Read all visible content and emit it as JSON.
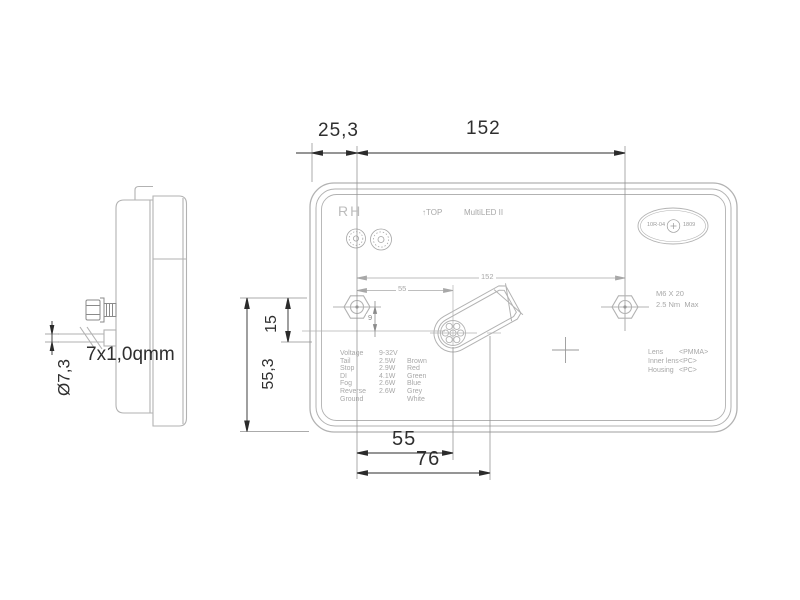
{
  "drawing": {
    "side_view": {
      "cable_spec": "7x1,0qmm",
      "cable_diameter": "Ø7,3",
      "icons": [
        "mounting-stud-icon",
        "cable-break-icon"
      ]
    },
    "dims": {
      "top_offset": "25,3",
      "hole_spacing_top": "152",
      "hole_spacing_inner": "152",
      "connector_offset_inner": "55",
      "hole_drop": "9",
      "side_upper": "15",
      "side_lower": "55,3",
      "bottom_connector": "55",
      "bottom_tip": "76"
    },
    "front_view": {
      "hand_label": "RH",
      "top_marker": "↑TOP",
      "model": "MultiLED II",
      "stamp_left": "10R-04",
      "stamp_right": "1809",
      "stamp_center_icon": "e-mark-circle-icon",
      "cert_icons": [
        "approval-mark-icon",
        "approval-mark-icon"
      ],
      "stud_spec": "M6 X 20",
      "torque_spec": "2.5 Nm  Max",
      "spec_rows": [
        {
          "label": "Voltage",
          "value": "9-32V",
          "wire": ""
        },
        {
          "label": "Tail",
          "value": "2.5W",
          "wire": "Brown"
        },
        {
          "label": "Stop",
          "value": "2.9W",
          "wire": "Red"
        },
        {
          "label": "DI",
          "value": "4.1W",
          "wire": "Green"
        },
        {
          "label": "Fog",
          "value": "2.6W",
          "wire": "Blue"
        },
        {
          "label": "Reverse",
          "value": "2.6W",
          "wire": "Grey"
        },
        {
          "label": "Ground",
          "value": "",
          "wire": "White"
        }
      ],
      "materials": [
        {
          "label": "Lens",
          "value": "<PMMA>"
        },
        {
          "label": "Inner lens",
          "value": "<PC>"
        },
        {
          "label": "Housing",
          "value": "<PC>"
        }
      ]
    },
    "colors": {
      "outline": "#b2b2b2",
      "dimension": "#2b2b2b",
      "annotation": "#a8a8a8"
    }
  }
}
